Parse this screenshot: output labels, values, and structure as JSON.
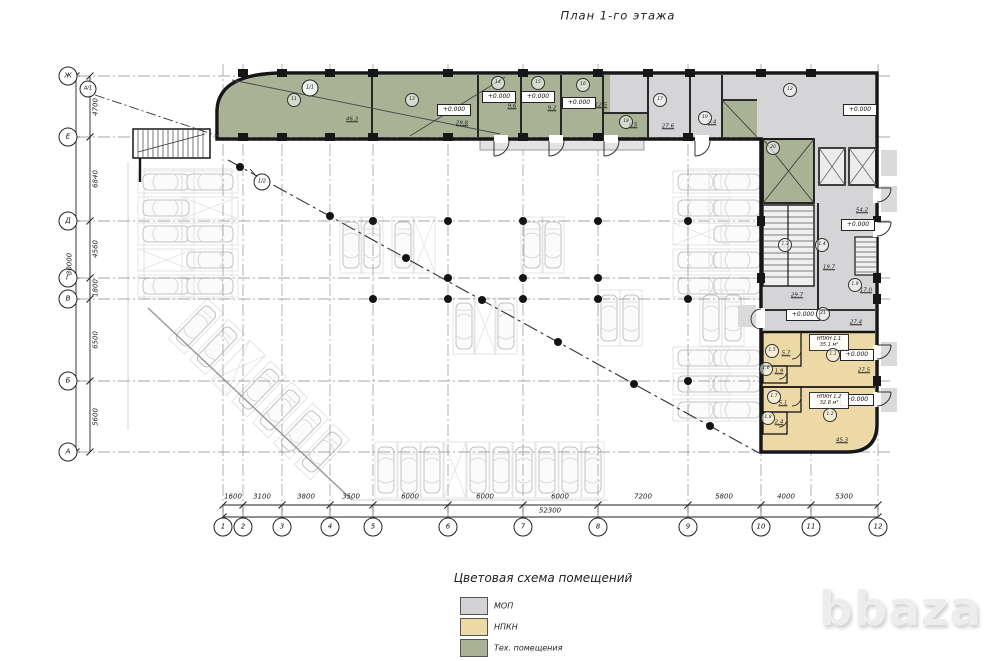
{
  "title": "План 1-го этажа",
  "watermark": "bbaza",
  "legend": {
    "title": "Цветовая схема  помещений",
    "items": [
      {
        "label": "МОП",
        "color": "#d3d3d5"
      },
      {
        "label": "НПКН",
        "color": "#ecd9a4"
      },
      {
        "label": "Тех. помещения",
        "color": "#a9b295"
      }
    ]
  },
  "axes": {
    "rows": [
      "Ж",
      "Е",
      "Д",
      "Г",
      "В",
      "Б",
      "А"
    ],
    "cols": [
      "1",
      "2",
      "3",
      "4",
      "5",
      "6",
      "7",
      "8",
      "9",
      "10",
      "11",
      "12"
    ],
    "extra": [
      "А/1",
      "1/1",
      "1/2"
    ]
  },
  "dims": {
    "left": [
      "4700",
      "6840",
      "4560",
      "1800",
      "6500",
      "5600"
    ],
    "left_total": "30000",
    "bottom": [
      "1600",
      "3100",
      "3800",
      "3500",
      "6000",
      "6000",
      "6000",
      "7200",
      "5800",
      "4000",
      "5300"
    ],
    "bottom_total": "52300"
  },
  "elevation": "+0.000",
  "units": [
    {
      "name": "НПКН 1.1",
      "size": "35.1 м²"
    },
    {
      "name": "НПКН 1.2",
      "size": "32.8 м²"
    }
  ],
  "areas": [
    "46.3",
    "29.8",
    "9.6",
    "9.2",
    "12.5",
    "6.5",
    "27.6",
    "5.4",
    "54.2",
    "19.7",
    "29.7",
    "17.0",
    "27.4",
    "27.5",
    "5.7",
    "1.9",
    "5.1",
    "2.4",
    "45.3"
  ],
  "bubbles": [
    "11",
    "13",
    "14",
    "15",
    "16",
    "17",
    "18",
    "19",
    "12",
    "20",
    "1.3",
    "1.4",
    "1.9",
    "21",
    "1.1",
    "1.5",
    "1.6",
    "1.2",
    "1.7",
    "1.8"
  ],
  "colors": {
    "tech": "#a9b295",
    "mop": "#d5d5d7",
    "npkn": "#edd9a6",
    "wall": "#161616"
  }
}
